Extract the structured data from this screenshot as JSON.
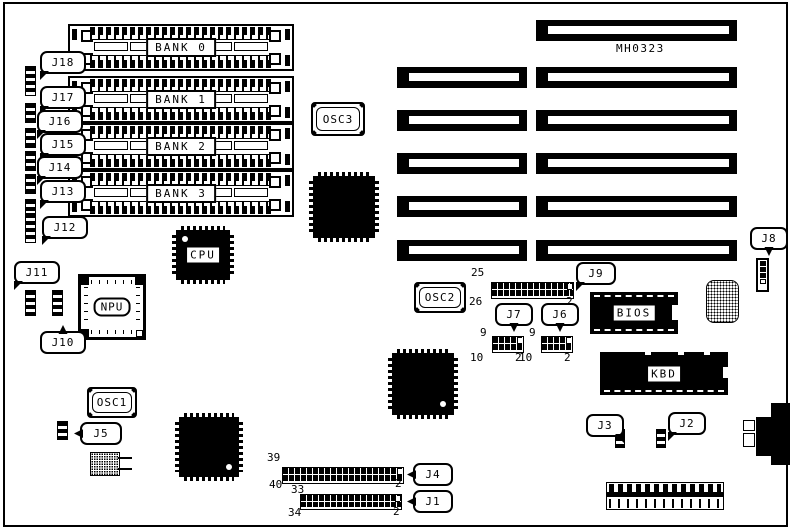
{
  "board": {
    "marking": "MH0323"
  },
  "banks": [
    {
      "label": "BANK 0"
    },
    {
      "label": "BANK 1"
    },
    {
      "label": "BANK 2"
    },
    {
      "label": "BANK 3"
    }
  ],
  "chips": {
    "cpu": {
      "label": "CPU"
    },
    "npu": {
      "label": "NPU"
    },
    "bios": {
      "label": "BIOS"
    },
    "kbd": {
      "label": "KBD"
    }
  },
  "oscillators": {
    "osc1": {
      "label": "OSC1"
    },
    "osc2": {
      "label": "OSC2"
    },
    "osc3": {
      "label": "OSC3"
    }
  },
  "callouts": {
    "j1": {
      "label": "J1"
    },
    "j2": {
      "label": "J2"
    },
    "j3": {
      "label": "J3"
    },
    "j4": {
      "label": "J4"
    },
    "j5": {
      "label": "J5"
    },
    "j6": {
      "label": "J6"
    },
    "j7": {
      "label": "J7"
    },
    "j8": {
      "label": "J8"
    },
    "j9": {
      "label": "J9"
    },
    "j10": {
      "label": "J10"
    },
    "j11": {
      "label": "J11"
    },
    "j12": {
      "label": "J12"
    },
    "j13": {
      "label": "J13"
    },
    "j14": {
      "label": "J14"
    },
    "j15": {
      "label": "J15"
    },
    "j16": {
      "label": "J16"
    },
    "j17": {
      "label": "J17"
    },
    "j18": {
      "label": "J18"
    }
  },
  "headers": {
    "j9": {
      "pin_first_top": "25",
      "pin_first_bottom": "26",
      "pin_last": "2"
    },
    "j7": {
      "pin_first_top": "9",
      "pin_first_bottom": "10",
      "pin_last": "2"
    },
    "j6": {
      "pin_first_top": "9",
      "pin_first_bottom": "10",
      "pin_last": "2"
    },
    "j4": {
      "pin_first_top": "39",
      "pin_first_bottom": "40",
      "pin_last": "2"
    },
    "j1": {
      "pin_first_top": "33",
      "pin_first_bottom": "34",
      "pin_last": "2"
    }
  }
}
